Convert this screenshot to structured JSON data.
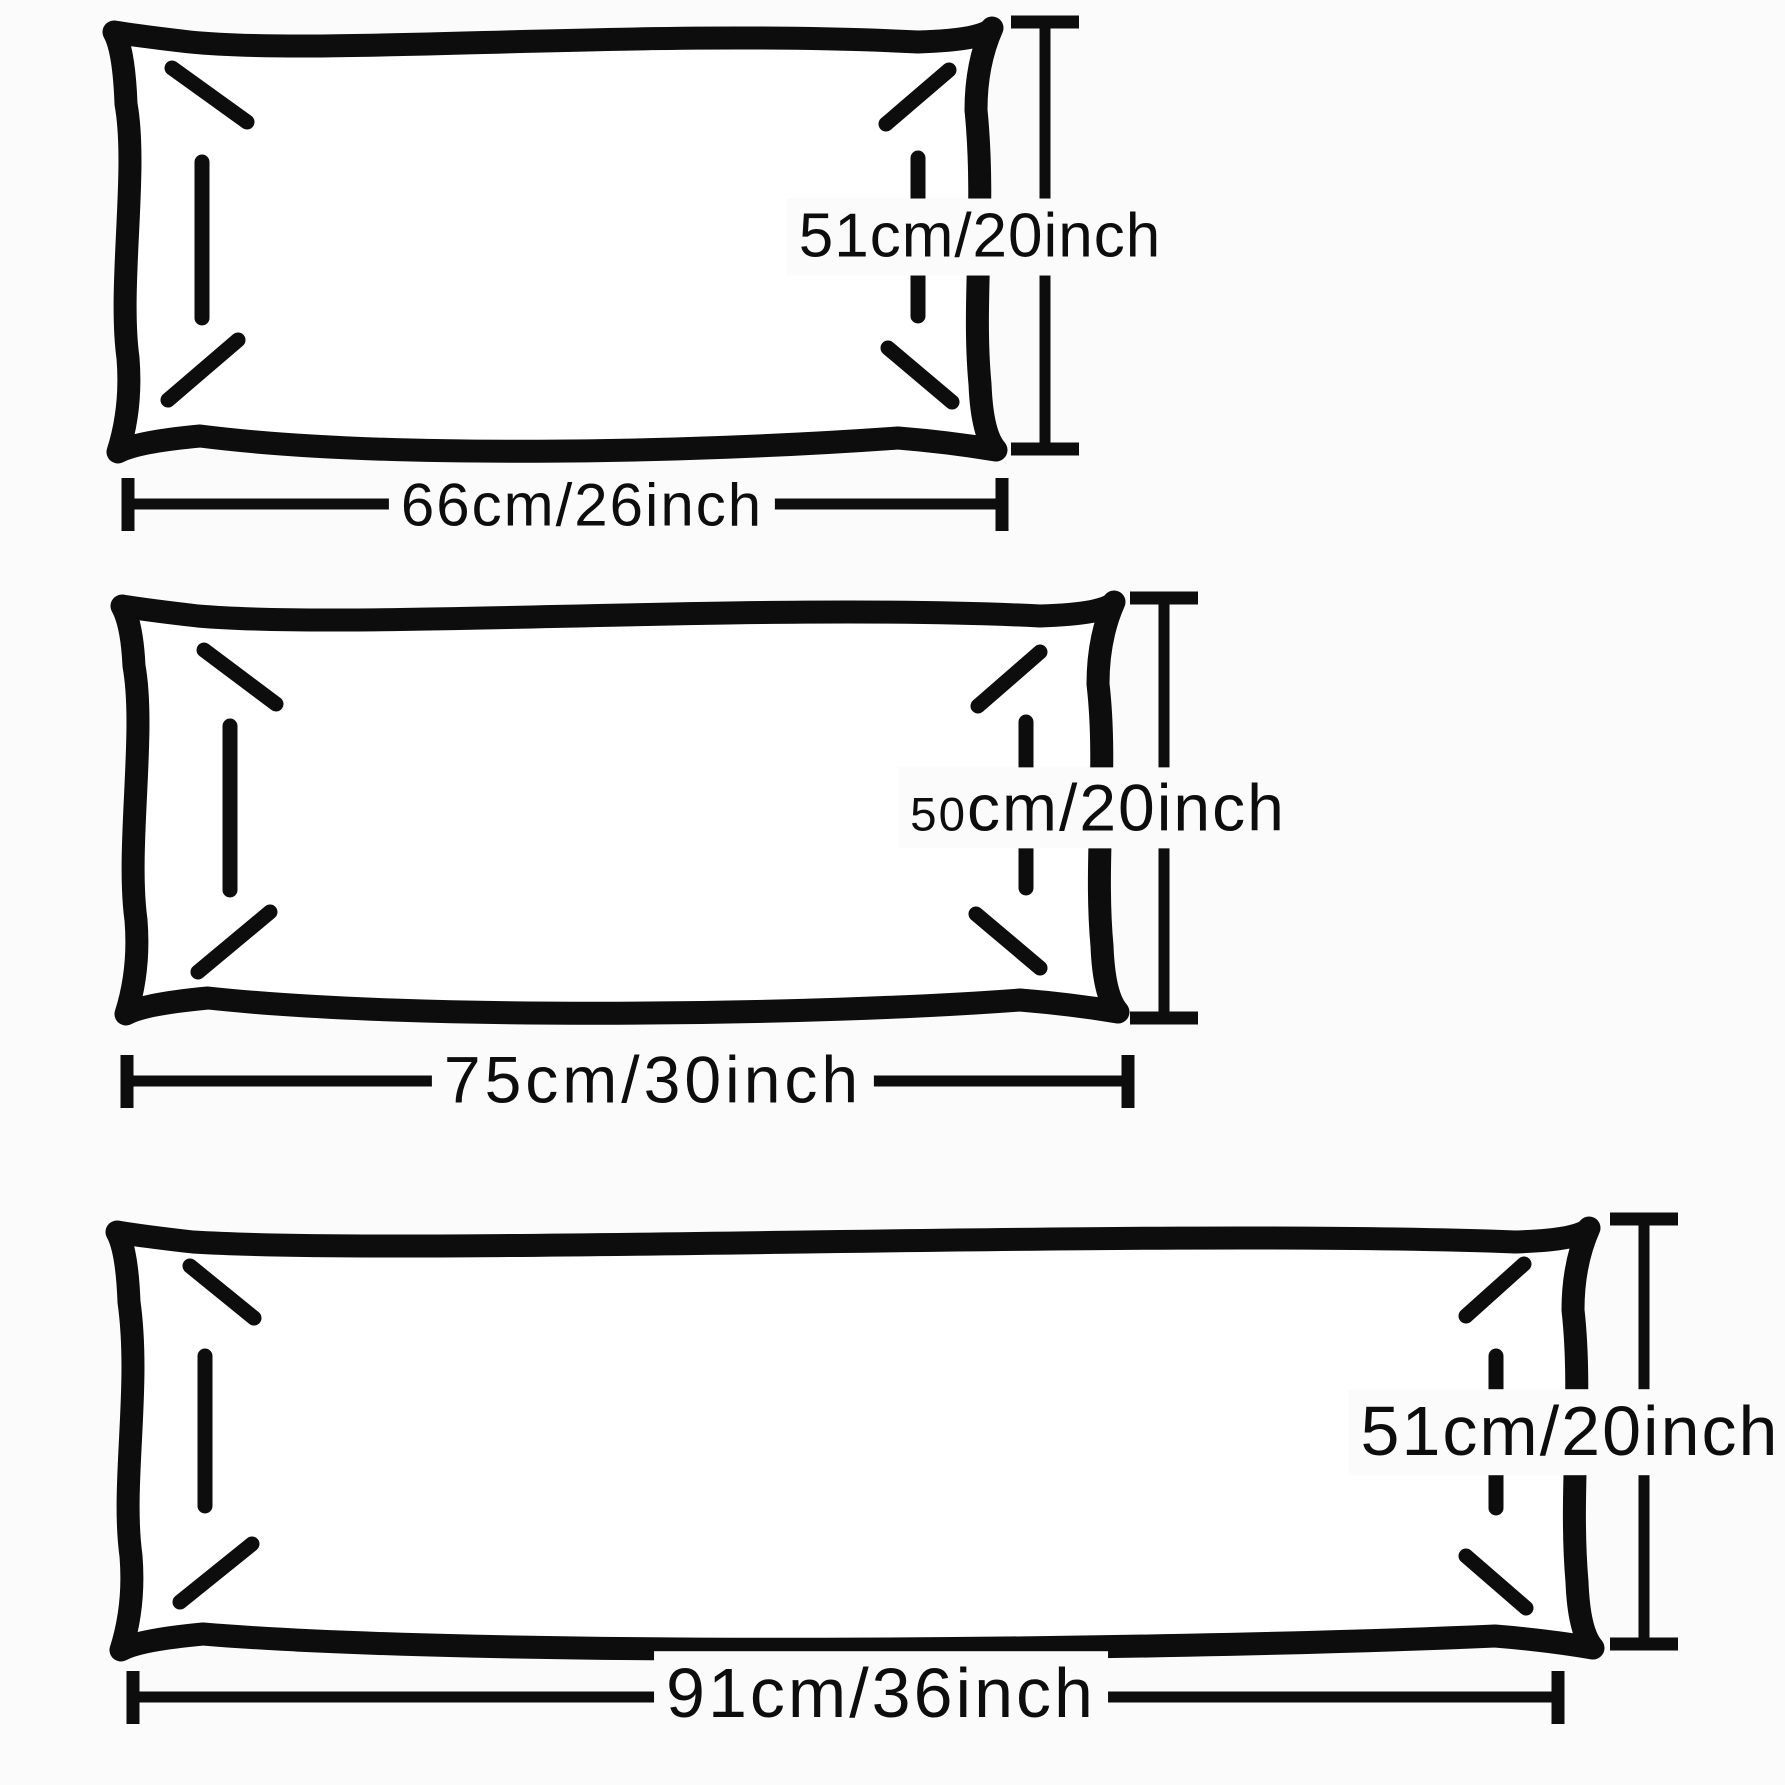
{
  "theme": {
    "bg": "#fbfbfb",
    "ink": "#0d0d0d"
  },
  "diagram_title": "Pillow size diagram",
  "pillows": [
    {
      "name": "small-pillow",
      "height": {
        "text": "51cm/20inch"
      },
      "width": {
        "text": "66cm/26inch"
      }
    },
    {
      "name": "medium-pillow",
      "height": {
        "prefix": "50",
        "suffix": "cm/20inch"
      },
      "width": {
        "text": "75cm/30inch"
      }
    },
    {
      "name": "large-pillow",
      "height": {
        "text": "51cm/20inch"
      },
      "width": {
        "text": "91cm/36inch"
      }
    }
  ]
}
